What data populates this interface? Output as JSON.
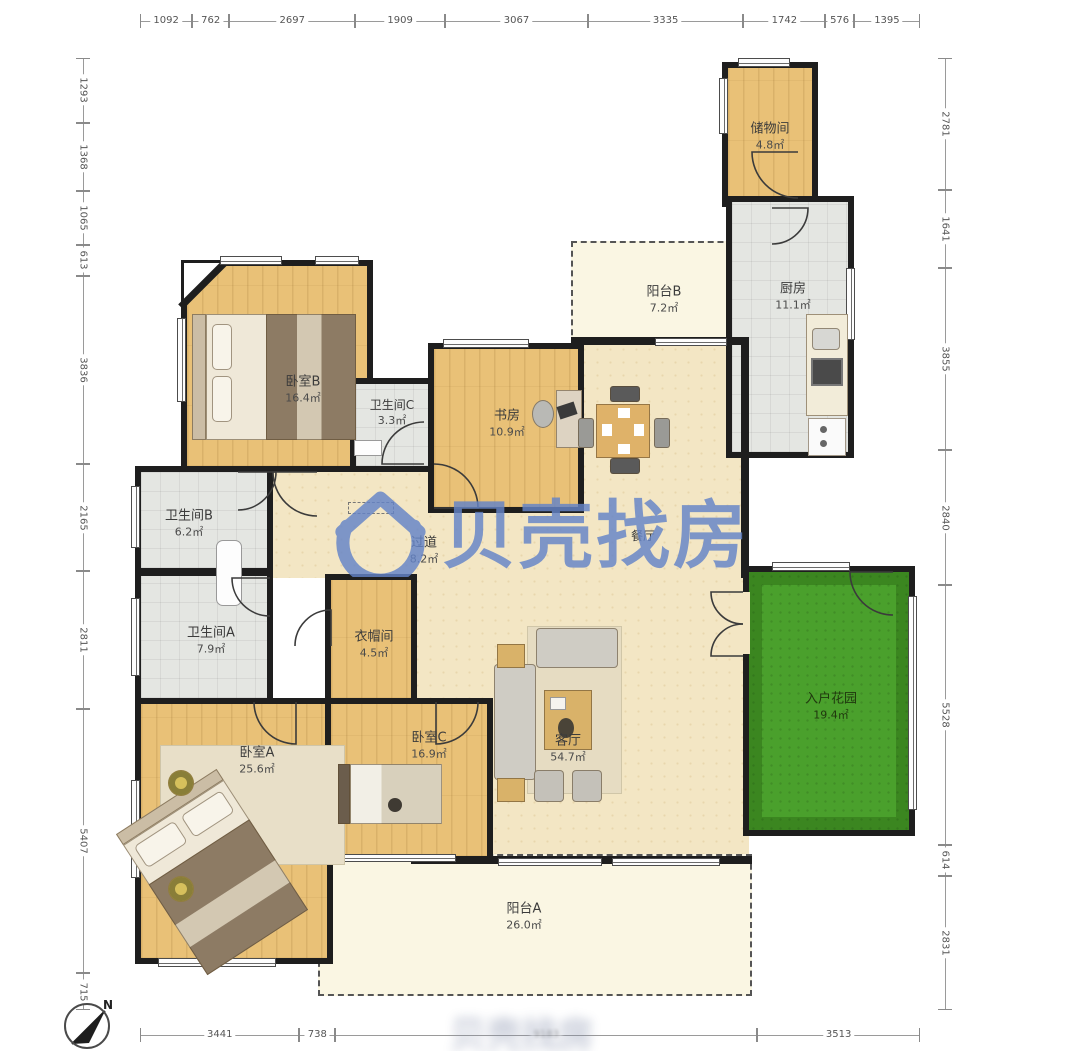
{
  "watermark": {
    "brand": "贝壳找房"
  },
  "compass": {
    "label": "N"
  },
  "rulers": {
    "top": [
      "1092",
      "762",
      "2697",
      "1909",
      "3067",
      "3335",
      "1742",
      "576",
      "1395"
    ],
    "bottom": [
      "3441",
      "738",
      "9183",
      "3513"
    ],
    "left": [
      "1293",
      "1368",
      "1065",
      "613",
      "3836",
      "2165",
      "2811",
      "5407",
      "715"
    ],
    "right": [
      "2781",
      "1641",
      "3855",
      "2840",
      "5528",
      "614",
      "2831"
    ]
  },
  "rooms": {
    "storage": {
      "name": "储物间",
      "area": "4.8㎡"
    },
    "kitchen": {
      "name": "厨房",
      "area": "11.1㎡"
    },
    "balconyB": {
      "name": "阳台B",
      "area": "7.2㎡"
    },
    "bedroomB": {
      "name": "卧室B",
      "area": "16.4㎡"
    },
    "bathC": {
      "name": "卫生间C",
      "area": "3.3㎡"
    },
    "study": {
      "name": "书房",
      "area": "10.9㎡"
    },
    "dining": {
      "name": "餐厅",
      "area": ""
    },
    "corridor": {
      "name": "过道",
      "area": "8.2㎡"
    },
    "bathB": {
      "name": "卫生间B",
      "area": "6.2㎡"
    },
    "bathA": {
      "name": "卫生间A",
      "area": "7.9㎡"
    },
    "wardrobe": {
      "name": "衣帽间",
      "area": "4.5㎡"
    },
    "bedroomA": {
      "name": "卧室A",
      "area": "25.6㎡"
    },
    "bedroomC": {
      "name": "卧室C",
      "area": "16.9㎡"
    },
    "living": {
      "name": "客厅",
      "area": "54.7㎡"
    },
    "garden": {
      "name": "入户花园",
      "area": "19.4㎡"
    },
    "balconyA": {
      "name": "阳台A",
      "area": "26.0㎡"
    }
  },
  "colors": {
    "wall": "#1e1e1e",
    "wood_floor": "#e9c177",
    "tile_floor": "#e4e6e2",
    "open_floor": "#f3e6c4",
    "balcony_floor": "#faf6e3",
    "garden": "#4aa02c",
    "watermark_blue": "#6484c8"
  }
}
